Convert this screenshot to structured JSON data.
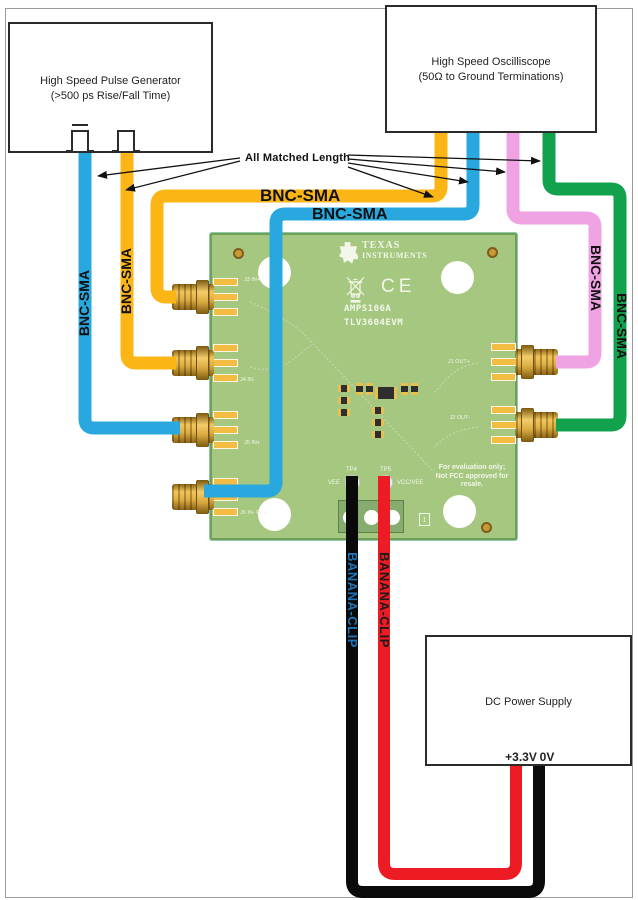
{
  "colors": {
    "blue": "#29A8E0",
    "yellow": "#FBB615",
    "green": "#12A24E",
    "pink": "#EFA3E3",
    "red": "#ED1C24",
    "black_wire": "#0A0A0A",
    "banana_left_label": "#1B75BC",
    "banana_right_label": "#1A1A1A"
  },
  "instruments": {
    "pulse_generator": {
      "line1": "High Speed Pulse Generator",
      "line2": "(>500 ps Rise/Fall Time)"
    },
    "oscilloscope": {
      "line1": "High Speed Oscilliscope",
      "line2": "(50Ω  to Ground Terminations)"
    },
    "power_supply": {
      "label": "DC Power Supply",
      "positive_terminal": "+3.3V",
      "negative_terminal": "0V"
    }
  },
  "annotations": {
    "matched_length": "All Matched Length",
    "bnc_sma": "BNC-SMA",
    "banana_clip": "BANANA-CLIP"
  },
  "board": {
    "logo_line1": "TEXAS",
    "logo_line2": "INSTRUMENTS",
    "ce_mark": "CE",
    "part_number": "AMPS106A",
    "evm_name": "TLV3604EVM",
    "eval_line1": "For evaluation only;",
    "eval_line2": "Not FCC approved for resale.",
    "symbol_1": "1",
    "test_points": {
      "tp4": "TP4",
      "tp5": "TP5",
      "tp4_signal": "VEE",
      "tp5_signal": "VCC/VEE"
    },
    "left_connectors": [
      "J3 IN+",
      "J4 IN-",
      "J5 IN+",
      "J6 IN- REF"
    ],
    "right_connectors": [
      "J1 OUT+",
      "J2 OUT-"
    ]
  }
}
